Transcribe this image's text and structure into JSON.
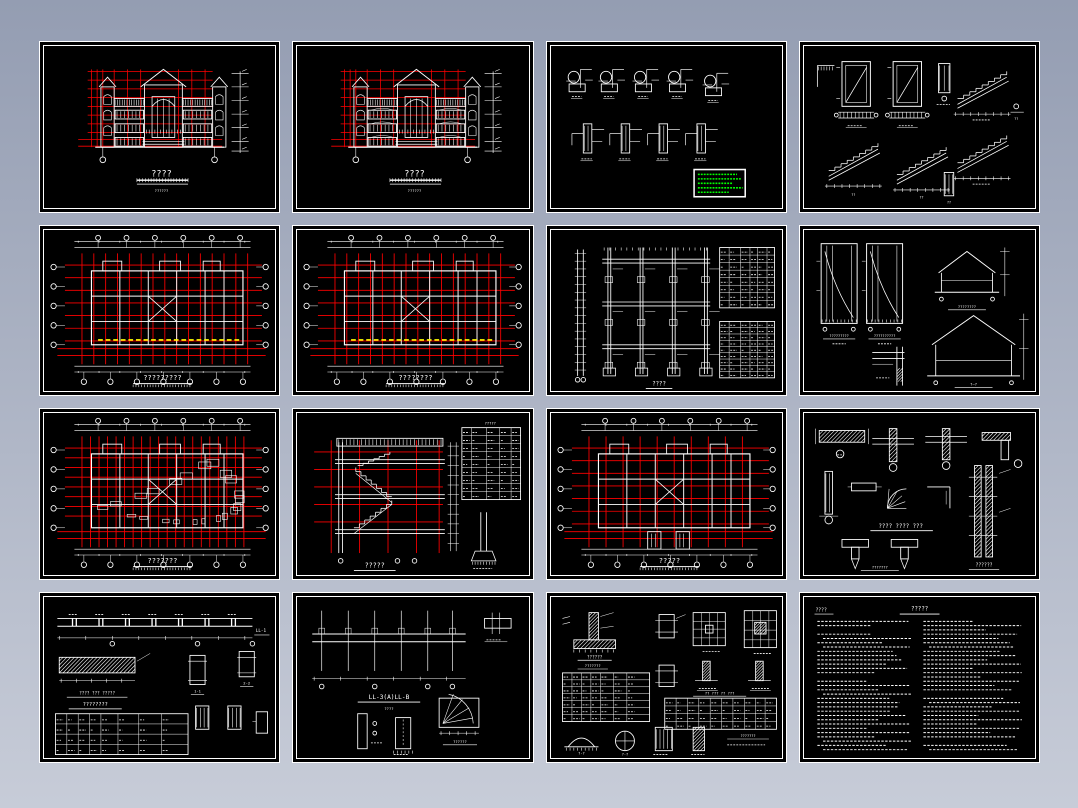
{
  "page": {
    "bg_top": "#949db2",
    "bg_bottom": "#c7ccd8",
    "canvas_color": "#000000"
  },
  "colors": {
    "line_white": "#ffffff",
    "grid_red": "#ff0000",
    "highlight_yellow": "#ffff00",
    "notes_green": "#00ff00"
  },
  "sheets": [
    {
      "title": "????",
      "scale_note": "??????"
    },
    {
      "title": "????",
      "scale_note": "??????"
    },
    {
      "label_a": "??",
      "label_b": "???"
    },
    {
      "label_1": "??",
      "label_2": "??",
      "label_3": "??",
      "label_4": "??"
    },
    {
      "title": "?????????"
    },
    {
      "title": "????????"
    },
    {
      "title": "????"
    },
    {
      "label_left1": "?????????",
      "label_left2": "??????????",
      "label_right1": "????????",
      "label_right2": "?—?"
    },
    {
      "title": "???????"
    },
    {
      "title": "?????",
      "table_title": "?????"
    },
    {
      "title": "?????"
    },
    {
      "text1": "???? ???? ???",
      "text2": "??????",
      "text3": "???????"
    },
    {
      "beam_label": "LL-1",
      "text1": "???? ??? ?????",
      "text2": "????????",
      "sec1": "1-1",
      "sec2": "2-2"
    },
    {
      "title": "LL-3(A)LL-B",
      "subtitle": "????",
      "label": "??????"
    },
    {
      "text1": "??????",
      "text2": "???????",
      "table_heading": "?? ??? ?? ???",
      "note": "???????",
      "sec1": "?-?",
      "sec2": "?-?"
    },
    {
      "corner": "????",
      "title": "?????"
    }
  ]
}
